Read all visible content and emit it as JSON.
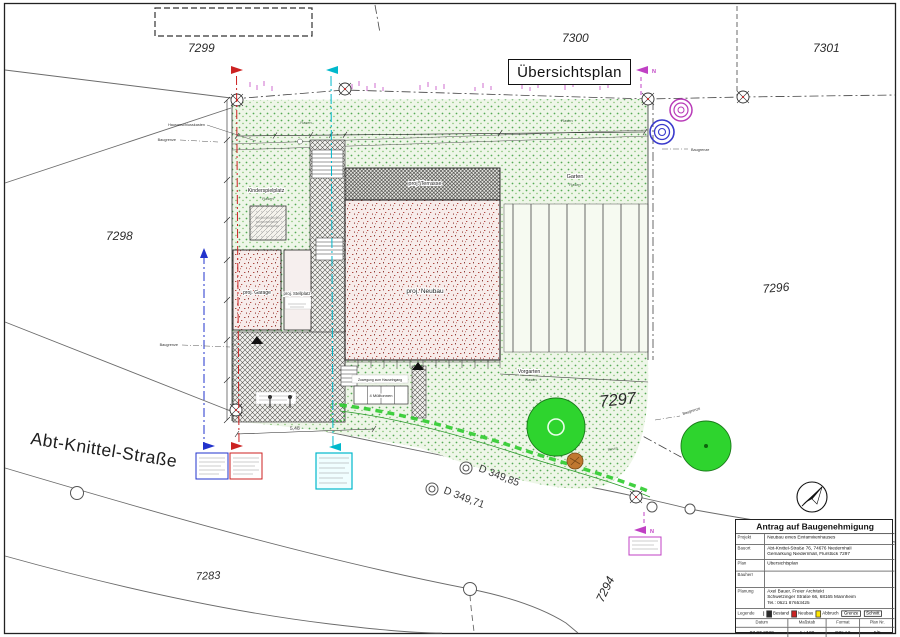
{
  "plan": {
    "title": "Übersichtsplan",
    "street_name": "Abt-Knittel-Straße",
    "north_label": "N"
  },
  "parcels": {
    "p7299": "7299",
    "p7300": "7300",
    "p7301": "7301",
    "p7298": "7298",
    "p7296": "7296",
    "p7297": "7297",
    "p7294": "7294",
    "p7283": "7283"
  },
  "labels": {
    "neubau": "proj. Neubau",
    "terrasse": "proj. Terrasse",
    "garage": "proj. Garage",
    "stellplatz": "proj. Stellplatz",
    "kinderspielplatz": "Kinderspielplatz",
    "garten": "Garten",
    "vorgarten": "Vorgarten",
    "rasen": "Rasen",
    "baugrenze": "Baugrenze",
    "hausanschluss": "Hausanschlusskasten",
    "muelltonnen": "4 Mülltonnen",
    "zuwegung": "Zuwegung zum Hauseingang",
    "dim_bottom": "5,48"
  },
  "elevations": {
    "d1": "D 349,85",
    "d2": "D 349,71"
  },
  "titleblock": {
    "header": "Antrag auf Baugenehmigung",
    "projekt_label": "Projekt",
    "projekt": "Neubau eines Einfamilienhauses",
    "bauort_label": "Bauort",
    "bauort1": "Abt-Knittel-Straße 76, 74676 Niedernhall",
    "bauort2": "Gemarkung Niedernhall, Flurstück 7297",
    "plan_label": "Plan",
    "plan": "Übersichtsplan",
    "bauherr_label": "Bauherr",
    "bauherr": "",
    "planung_label": "Planung",
    "planung1": "Axel Bauer, Freier Architekt",
    "planung2": "Schwetzinger Straße 66, 68165 Mannheim",
    "planung3": "Tel.: 0621 87653425",
    "legende_label": "Legende",
    "legend_bestand": "Bestand",
    "legend_neubau": "Neubau",
    "legend_abbruch": "Abbruch",
    "legend_grenze": "Grenze",
    "legend_schnitt": "Schnitt",
    "datum_label": "Datum",
    "datum": "07.07.2020",
    "massstab_label": "Maßstab",
    "massstab": "1 : 100",
    "format_label": "Format",
    "format": "DIN A2",
    "plannr_label": "Plan Nr.",
    "plannr": "5/5"
  },
  "colors": {
    "lawn_bg": "#eef6e8",
    "lawn_dot": "#55aa55",
    "tree_green": "#2ed42e",
    "neubau_red": "#b04a42",
    "bestand_hatch": "#55544e",
    "abbruch_yellow": "#ffe600",
    "section_red": "#cc2222",
    "section_blue": "#2233cc",
    "section_cyan": "#00b8cc",
    "section_magenta": "#c040c4",
    "shrub_brown": "#c07830"
  }
}
